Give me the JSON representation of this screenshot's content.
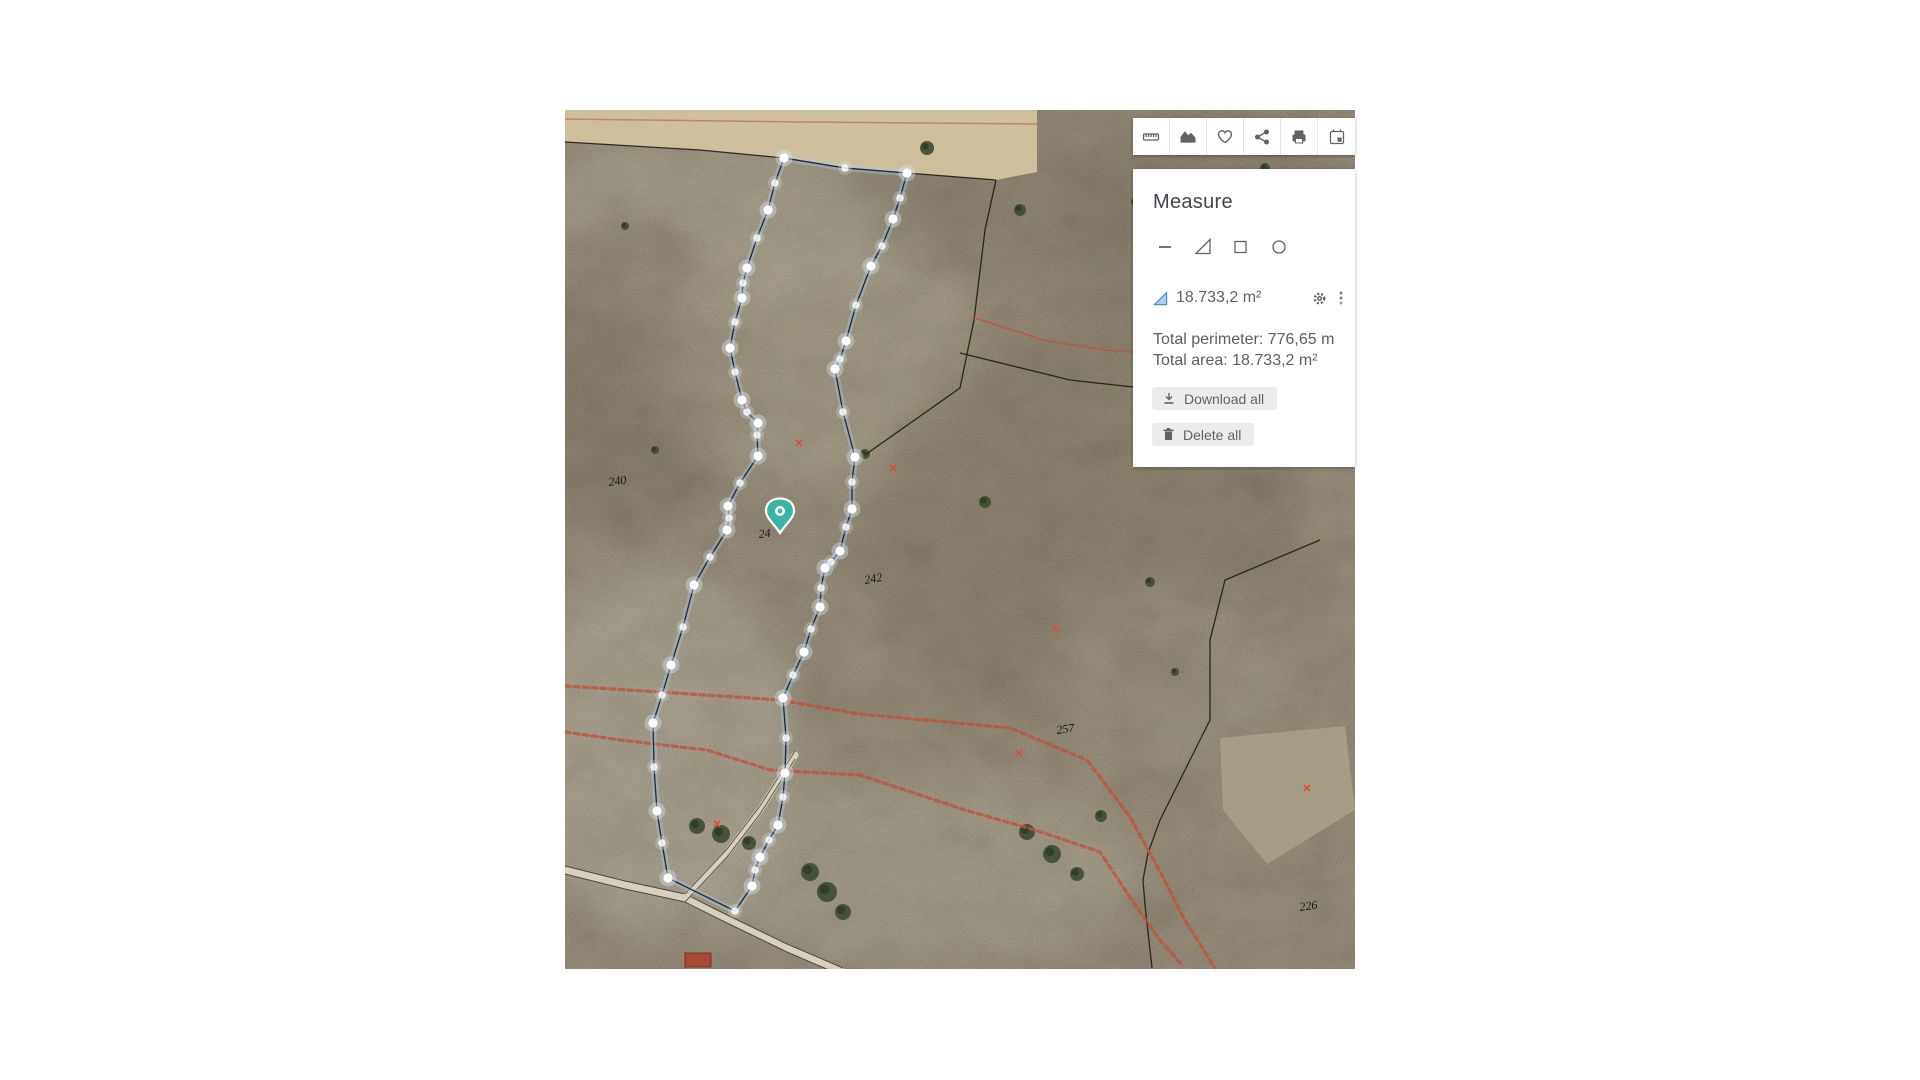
{
  "toolbar": {
    "items": [
      {
        "name": "ruler"
      },
      {
        "name": "elevation-chart"
      },
      {
        "name": "favorite-heart"
      },
      {
        "name": "share"
      },
      {
        "name": "print"
      },
      {
        "name": "calendar-event"
      }
    ]
  },
  "panel": {
    "title": "Measure",
    "tools": [
      {
        "name": "line"
      },
      {
        "name": "area-triangle"
      },
      {
        "name": "rectangle"
      },
      {
        "name": "circle"
      }
    ],
    "measurement": {
      "value": "18.733,2 m²"
    },
    "totals": {
      "perimeter": "Total perimeter: 776,65 m",
      "area": "Total area: 18.733,2 m²"
    },
    "buttons": {
      "download": "Download all",
      "delete": "Delete all"
    }
  },
  "colors": {
    "accent_teal": "#3ab5a3",
    "vertex_line": "#1b2a36",
    "vertex_glow": "rgba(173,205,235,0.35)",
    "black_line": "#1c1c1c",
    "red_path": "#c0503a",
    "tan_field": "#d3c49e",
    "plowed_field": "#aba189",
    "road_fill": "#d8d0bd",
    "tree_green": "#3d4b33",
    "marker_red": "#d94f38",
    "label_black": "#141414"
  },
  "map": {
    "width": 790,
    "height": 859,
    "labels": [
      {
        "text": "240",
        "x": 44,
        "y": 376,
        "rot": -8
      },
      {
        "text": "24",
        "x": 194,
        "y": 428,
        "rot": -6
      },
      {
        "text": "242",
        "x": 300,
        "y": 474,
        "rot": -10
      },
      {
        "text": "257",
        "x": 492,
        "y": 624,
        "rot": -8
      },
      {
        "text": "226",
        "x": 735,
        "y": 801,
        "rot": -8
      }
    ],
    "red_markers": [
      [
        234,
        333
      ],
      [
        328,
        358
      ],
      [
        491,
        519
      ],
      [
        454,
        643
      ],
      [
        152,
        714
      ],
      [
        742,
        678
      ]
    ],
    "pin": {
      "x": 215,
      "y": 423
    },
    "polygon": [
      [
        219,
        48
      ],
      [
        280,
        58
      ],
      [
        342,
        63
      ],
      [
        335,
        88
      ],
      [
        328,
        109
      ],
      [
        317,
        136
      ],
      [
        306,
        156
      ],
      [
        291,
        195
      ],
      [
        281,
        231
      ],
      [
        275,
        249
      ],
      [
        270,
        259
      ],
      [
        278,
        302
      ],
      [
        290,
        347
      ],
      [
        287,
        372
      ],
      [
        287,
        399
      ],
      [
        281,
        417
      ],
      [
        275,
        441
      ],
      [
        266,
        452
      ],
      [
        260,
        458
      ],
      [
        256,
        478
      ],
      [
        255,
        497
      ],
      [
        246,
        519
      ],
      [
        239,
        542
      ],
      [
        228,
        565
      ],
      [
        218,
        588
      ],
      [
        221,
        628
      ],
      [
        220,
        663
      ],
      [
        218,
        687
      ],
      [
        213,
        715
      ],
      [
        204,
        730
      ],
      [
        195,
        747
      ],
      [
        190,
        760
      ],
      [
        187,
        776
      ],
      [
        170,
        801
      ],
      [
        103,
        768
      ],
      [
        97,
        733
      ],
      [
        92,
        701
      ],
      [
        89,
        657
      ],
      [
        88,
        613
      ],
      [
        97,
        585
      ],
      [
        106,
        555
      ],
      [
        118,
        517
      ],
      [
        129,
        475
      ],
      [
        145,
        447
      ],
      [
        162,
        420
      ],
      [
        164,
        408
      ],
      [
        163,
        396
      ],
      [
        175,
        373
      ],
      [
        193,
        346
      ],
      [
        192,
        325
      ],
      [
        193,
        313
      ],
      [
        182,
        302
      ],
      [
        177,
        290
      ],
      [
        170,
        262
      ],
      [
        165,
        238
      ],
      [
        170,
        212
      ],
      [
        177,
        188
      ],
      [
        178,
        173
      ],
      [
        182,
        158
      ],
      [
        192,
        128
      ],
      [
        203,
        100
      ],
      [
        210,
        73
      ]
    ],
    "tan_field": [
      [
        0,
        0
      ],
      [
        472,
        0
      ],
      [
        472,
        62
      ],
      [
        431,
        70
      ],
      [
        342,
        63
      ],
      [
        280,
        58
      ],
      [
        219,
        48
      ],
      [
        135,
        40
      ],
      [
        0,
        32
      ]
    ],
    "plowed_field": [
      [
        655,
        628
      ],
      [
        780,
        616
      ],
      [
        790,
        700
      ],
      [
        702,
        754
      ],
      [
        658,
        700
      ]
    ],
    "black_lines": [
      [
        [
          0,
          32
        ],
        [
          135,
          40
        ],
        [
          219,
          48
        ],
        [
          280,
          58
        ],
        [
          342,
          63
        ],
        [
          431,
          70
        ]
      ],
      [
        [
          431,
          70
        ],
        [
          420,
          120
        ],
        [
          409,
          210
        ],
        [
          395,
          278
        ],
        [
          300,
          345
        ]
      ],
      [
        [
          395,
          243
        ],
        [
          505,
          270
        ],
        [
          568,
          277
        ],
        [
          790,
          300
        ]
      ],
      [
        [
          755,
          430
        ],
        [
          660,
          470
        ],
        [
          645,
          530
        ],
        [
          645,
          610
        ],
        [
          625,
          650
        ],
        [
          595,
          710
        ],
        [
          583,
          743
        ],
        [
          578,
          770
        ],
        [
          580,
          795
        ],
        [
          587,
          858
        ]
      ]
    ],
    "red_paths": [
      [
        [
          0,
          9
        ],
        [
          240,
          12
        ],
        [
          472,
          14
        ]
      ],
      [
        [
          407,
          207
        ],
        [
          478,
          230
        ],
        [
          540,
          240
        ],
        [
          568,
          242
        ],
        [
          790,
          255
        ]
      ],
      [
        [
          0,
          576
        ],
        [
          95,
          582
        ],
        [
          215,
          590
        ],
        [
          295,
          604
        ],
        [
          445,
          618
        ],
        [
          522,
          650
        ],
        [
          535,
          667
        ],
        [
          565,
          707
        ],
        [
          598,
          767
        ],
        [
          618,
          807
        ],
        [
          650,
          858
        ]
      ],
      [
        [
          0,
          622
        ],
        [
          55,
          630
        ],
        [
          142,
          640
        ],
        [
          205,
          660
        ],
        [
          295,
          665
        ],
        [
          400,
          700
        ],
        [
          470,
          720
        ],
        [
          535,
          742
        ],
        [
          562,
          783
        ],
        [
          595,
          830
        ],
        [
          615,
          853
        ]
      ]
    ],
    "roads": [
      [
        [
          0,
          760
        ],
        [
          60,
          775
        ],
        [
          120,
          788
        ],
        [
          160,
          808
        ],
        [
          222,
          838
        ],
        [
          278,
          862
        ]
      ],
      [
        [
          230,
          645
        ],
        [
          195,
          700
        ],
        [
          162,
          743
        ],
        [
          120,
          788
        ]
      ]
    ],
    "buildings": [
      [
        120,
        843,
        26,
        14
      ]
    ],
    "trees": [
      [
        362,
        38,
        7
      ],
      [
        455,
        100,
        6
      ],
      [
        420,
        392,
        6
      ],
      [
        300,
        344,
        5
      ],
      [
        245,
        762,
        9
      ],
      [
        262,
        782,
        10
      ],
      [
        278,
        802,
        8
      ],
      [
        132,
        716,
        8
      ],
      [
        156,
        724,
        9
      ],
      [
        184,
        733,
        7
      ],
      [
        462,
        722,
        8
      ],
      [
        487,
        744,
        9
      ],
      [
        512,
        764,
        7
      ],
      [
        536,
        706,
        6
      ],
      [
        640,
        152,
        5
      ],
      [
        608,
        232,
        4
      ],
      [
        700,
        58,
        5
      ],
      [
        737,
        254,
        5
      ],
      [
        585,
        472,
        5
      ],
      [
        610,
        562,
        4
      ],
      [
        60,
        116,
        4
      ],
      [
        90,
        340,
        4
      ],
      [
        570,
        92,
        4
      ],
      [
        670,
        330,
        4
      ]
    ]
  }
}
